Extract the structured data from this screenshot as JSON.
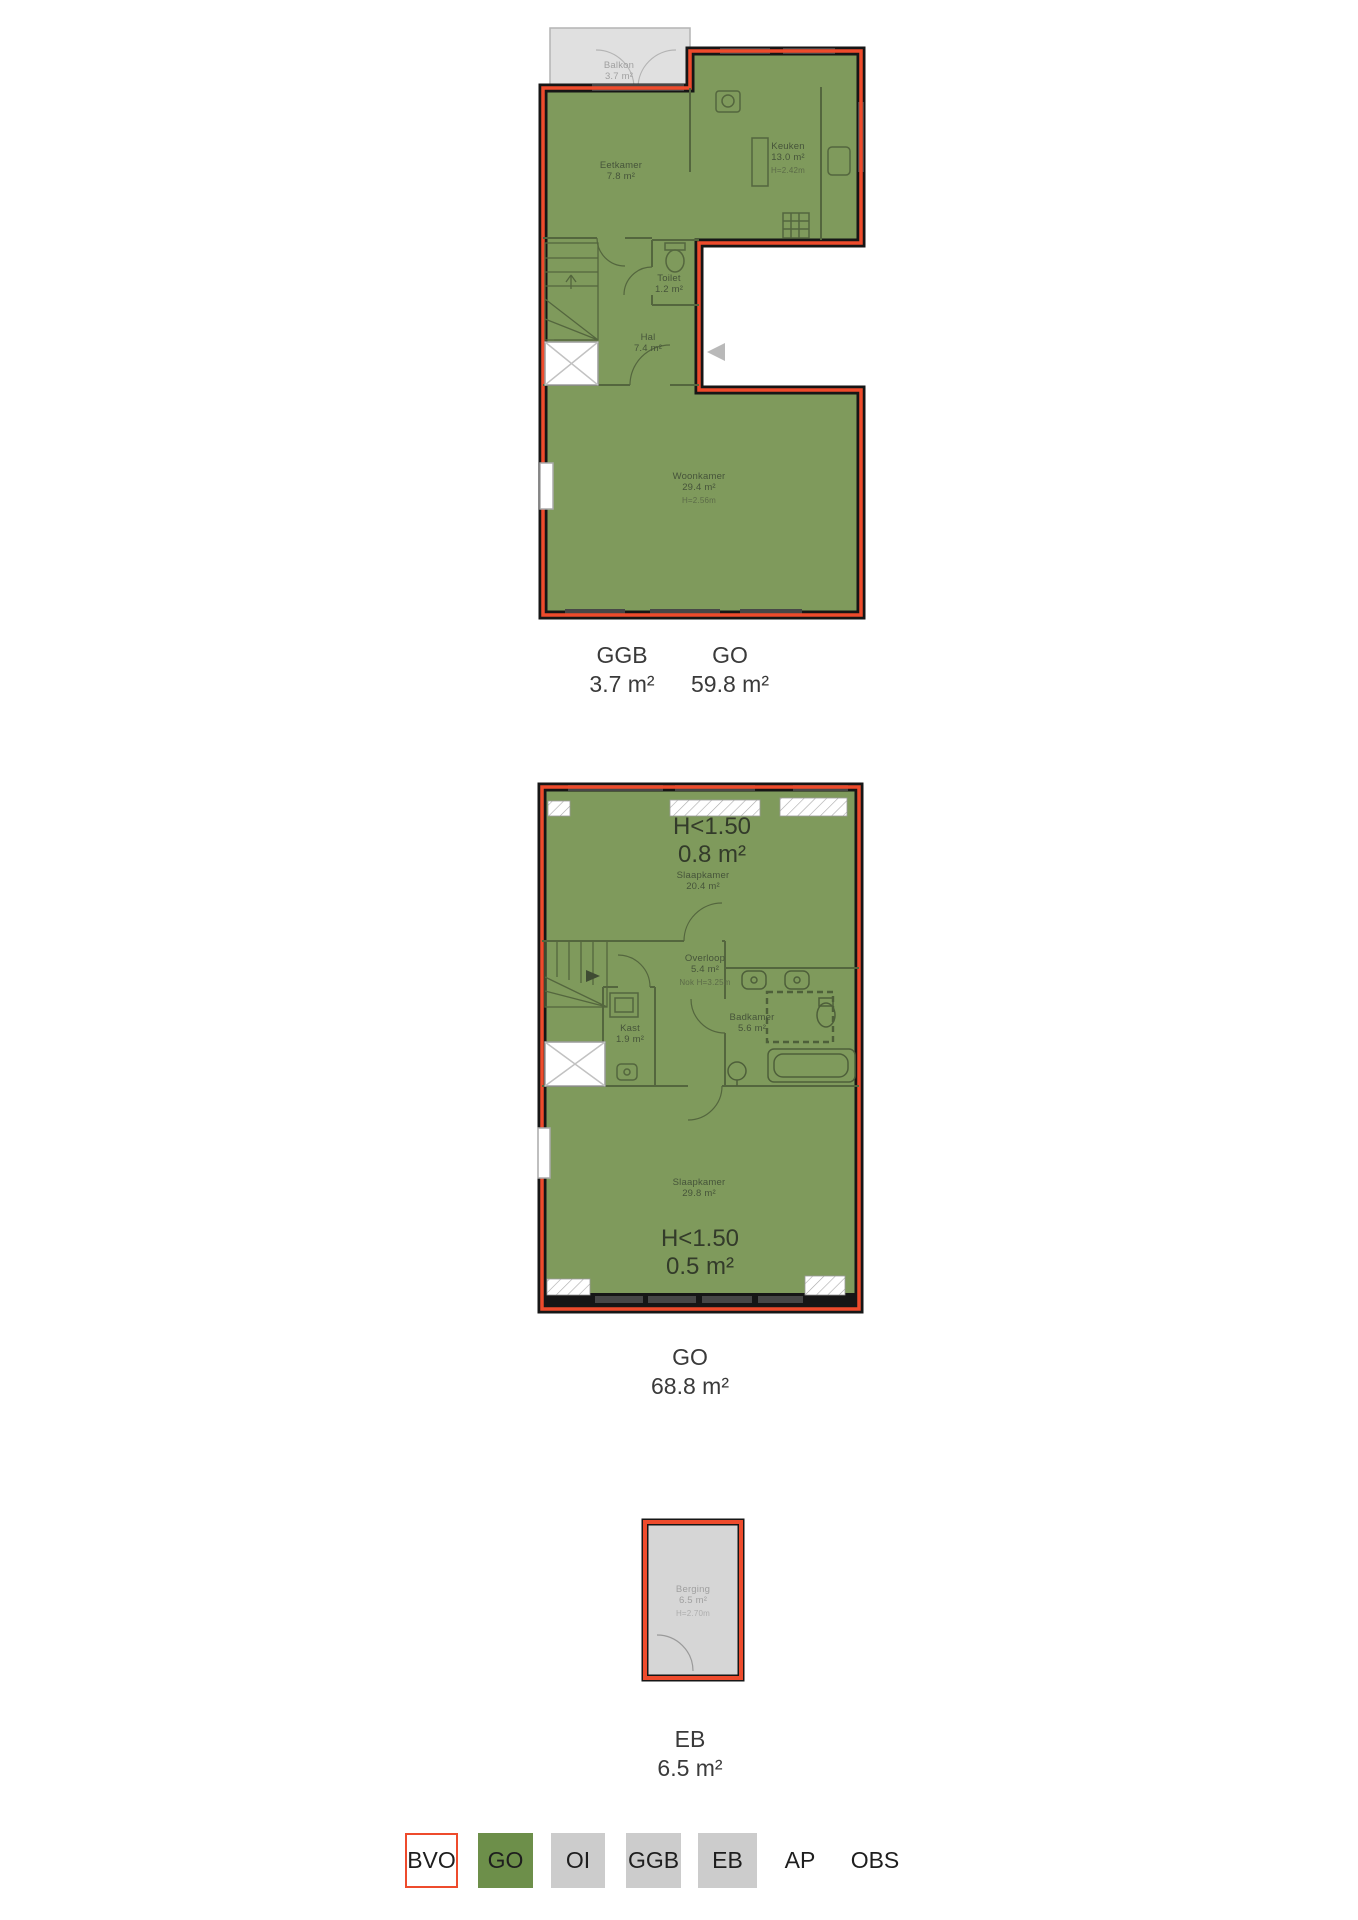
{
  "plans": {
    "floor1": {
      "rooms": {
        "balkon": {
          "name": "Balkon",
          "area": "3.7 m²"
        },
        "eetkamer": {
          "name": "Eetkamer",
          "area": "7.8 m²"
        },
        "keuken": {
          "name": "Keuken",
          "area": "13.0 m²",
          "height": "H=2.42m"
        },
        "toilet": {
          "name": "Toilet",
          "area": "1.2 m²"
        },
        "hal": {
          "name": "Hal",
          "area": "7.4 m²"
        },
        "woonkamer": {
          "name": "Woonkamer",
          "area": "29.4 m²",
          "height": "H=2.56m"
        }
      },
      "measurements": [
        {
          "code": "GGB",
          "value": "3.7 m²"
        },
        {
          "code": "GO",
          "value": "59.8 m²"
        }
      ]
    },
    "floor2": {
      "annotations": {
        "top": {
          "label": "H<1.50",
          "value": "0.8 m²"
        },
        "bottom": {
          "label": "H<1.50",
          "value": "0.5 m²"
        }
      },
      "rooms": {
        "slaapkamer1": {
          "name": "Slaapkamer",
          "area": "20.4 m²"
        },
        "overloop": {
          "name": "Overloop",
          "area": "5.4 m²",
          "height": "Nok H=3.25m"
        },
        "kast": {
          "name": "Kast",
          "area": "1.9 m²"
        },
        "badkamer": {
          "name": "Badkamer",
          "area": "5.6 m²"
        },
        "slaapkamer2": {
          "name": "Slaapkamer",
          "area": "29.8 m²"
        }
      },
      "measurements": [
        {
          "code": "GO",
          "value": "68.8 m²"
        }
      ]
    },
    "storage": {
      "rooms": {
        "berging": {
          "name": "Berging",
          "area": "6.5 m²",
          "height": "H=2.70m"
        }
      },
      "measurements": [
        {
          "code": "EB",
          "value": "6.5 m²"
        }
      ]
    }
  },
  "legend": {
    "items": [
      {
        "code": "BVO"
      },
      {
        "code": "GO"
      },
      {
        "code": "OI"
      },
      {
        "code": "GGB"
      },
      {
        "code": "EB"
      },
      {
        "code": "AP"
      },
      {
        "code": "OBS"
      }
    ]
  },
  "colors": {
    "plan_green": "#7f9a5c",
    "legend_green": "#6d8f4a",
    "outline_red": "#ee4b2c",
    "area_gray": "#d6d6d6",
    "wall_black": "#161616"
  }
}
